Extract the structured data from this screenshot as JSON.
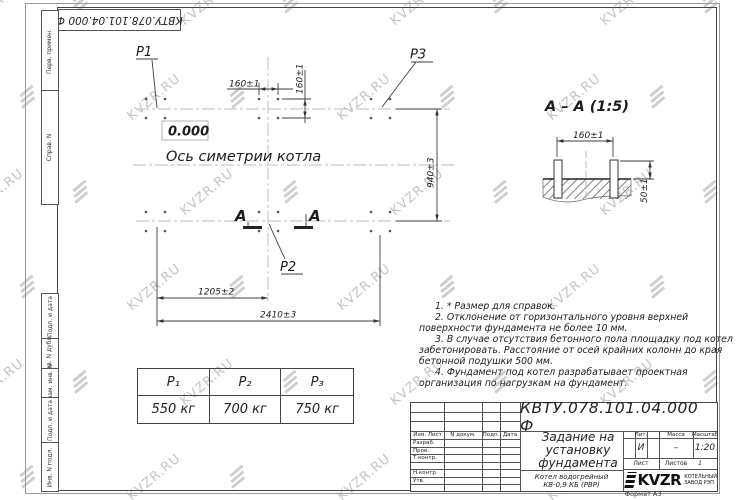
{
  "watermark": {
    "text": "KVZR.RU"
  },
  "doc_number": "КВТУ.078.101.04.000  Ф",
  "side_stamp": [
    "Перв. примен.",
    "Справ. N",
    "Подп. и дата",
    "Инв. N дубл.",
    "Взам. инв. N",
    "Подп. и дата",
    "Инв. N подл."
  ],
  "plan": {
    "p1": "P1",
    "p2": "P2",
    "p3": "P3",
    "level": "0.000",
    "axis_label": "Ось симетрии котла",
    "section_letter_left": "А",
    "section_letter_right": "А",
    "dim_top_h": "160±1",
    "dim_top_v": "160±1",
    "dim_right": "940±3",
    "dim_bottom_1": "1205±2",
    "dim_bottom_2": "2410±3"
  },
  "section": {
    "title": "А – А  (1:5)",
    "dim_width": "160±1",
    "dim_height": "50±1"
  },
  "notes": [
    "1. * Размер для справок.",
    "2. Отклонение от горизонтального уровня верхней поверхности фундамента не более 10 мм.",
    "3. В случае отсутствия бетонного пола площадку под котел забетонировать. Расстояние от осей крайних колонн до края бетонной подушки 500 мм.",
    "4. Фундамент под котел разрабатывает проектная организация по нагрузкам на фундамент."
  ],
  "load_table": {
    "headers": [
      "P₁",
      "P₂",
      "P₃"
    ],
    "values": [
      "550 кг",
      "700 кг",
      "750 кг"
    ]
  },
  "title_block": {
    "title_lines": [
      "Задание на",
      "установку",
      "фундамента"
    ],
    "product_lines": [
      "Котел водогрейный",
      "КВ-0,9 КБ (РВР)"
    ],
    "cols": {
      "izm": "Изм. Лист",
      "doc": "N докум.",
      "sign": "Подп.",
      "date": "Дата"
    },
    "rows": [
      "Разраб.",
      "Пров.",
      "Т.контр.",
      "",
      "Н.контр.",
      "Утв."
    ],
    "lit_label": "Лит.",
    "mass_label": "Масса",
    "scale_label": "Масштаб",
    "lit_value": "И",
    "mass_value": "–",
    "scale_value": "1:20",
    "sheet_label": "Лист",
    "sheets_label": "Листов",
    "sheets_value": "1",
    "brand": "KVZR",
    "brand_line1": "КОТЕЛЬНЫЙ",
    "brand_line2": "ЗАВОД РЭП",
    "format": "Формат А3"
  }
}
